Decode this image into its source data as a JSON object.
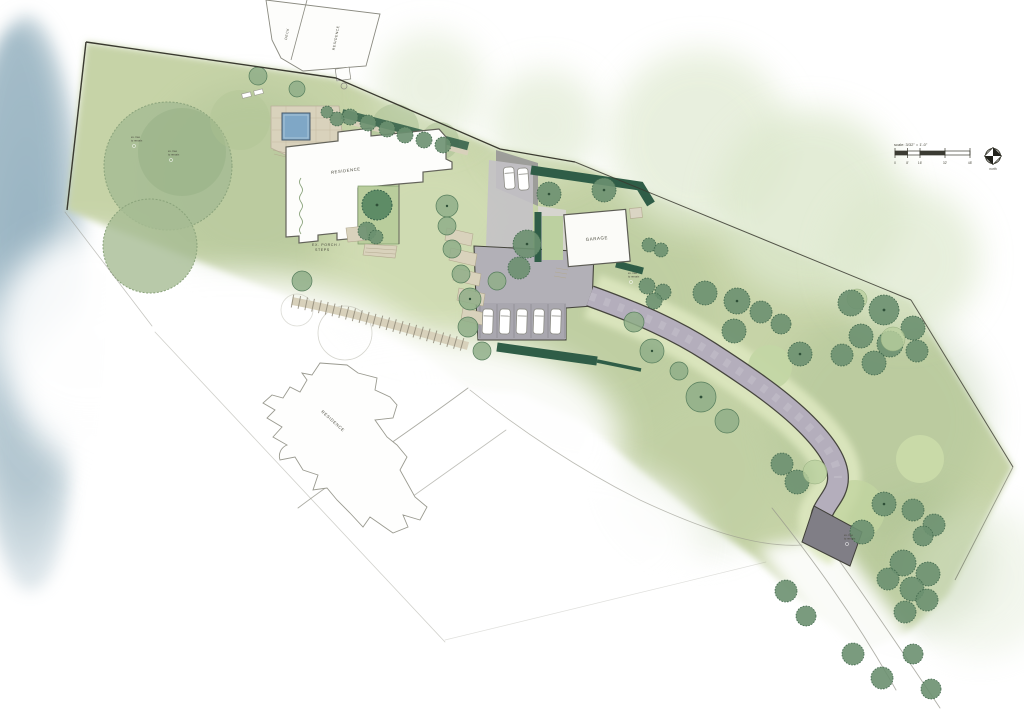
{
  "map": {
    "labels": {
      "main_residence": "RESIDENCE",
      "porch_line1": "EX. PORCH /",
      "porch_line2": "STEPS",
      "garage": "GARAGE",
      "neighbor_residence": "RESIDENCE",
      "top_residence": "RESIDENCE",
      "top_deck": "DECK"
    },
    "tree_tag": {
      "line1": "ex. tree",
      "line2": "to remain"
    },
    "scale_bar": {
      "label": "scale: 3/32\" = 1'-0\"",
      "ticks": [
        "0",
        "8'",
        "16'",
        "32'",
        "48'"
      ]
    },
    "compass": {
      "label": "north"
    },
    "colors": {
      "property_green": "#c6d3a7",
      "canopy_sage": "#a6bc94",
      "hedge_green": "#2f5d47",
      "tree_green": "#6b9070",
      "pool_blue": "#7fa7c6",
      "water_blue": "#9fb9c6",
      "driveway_gray": "#b4aebc",
      "paving_tan": "#d9d2bc",
      "ink": "#3a3a30"
    }
  }
}
